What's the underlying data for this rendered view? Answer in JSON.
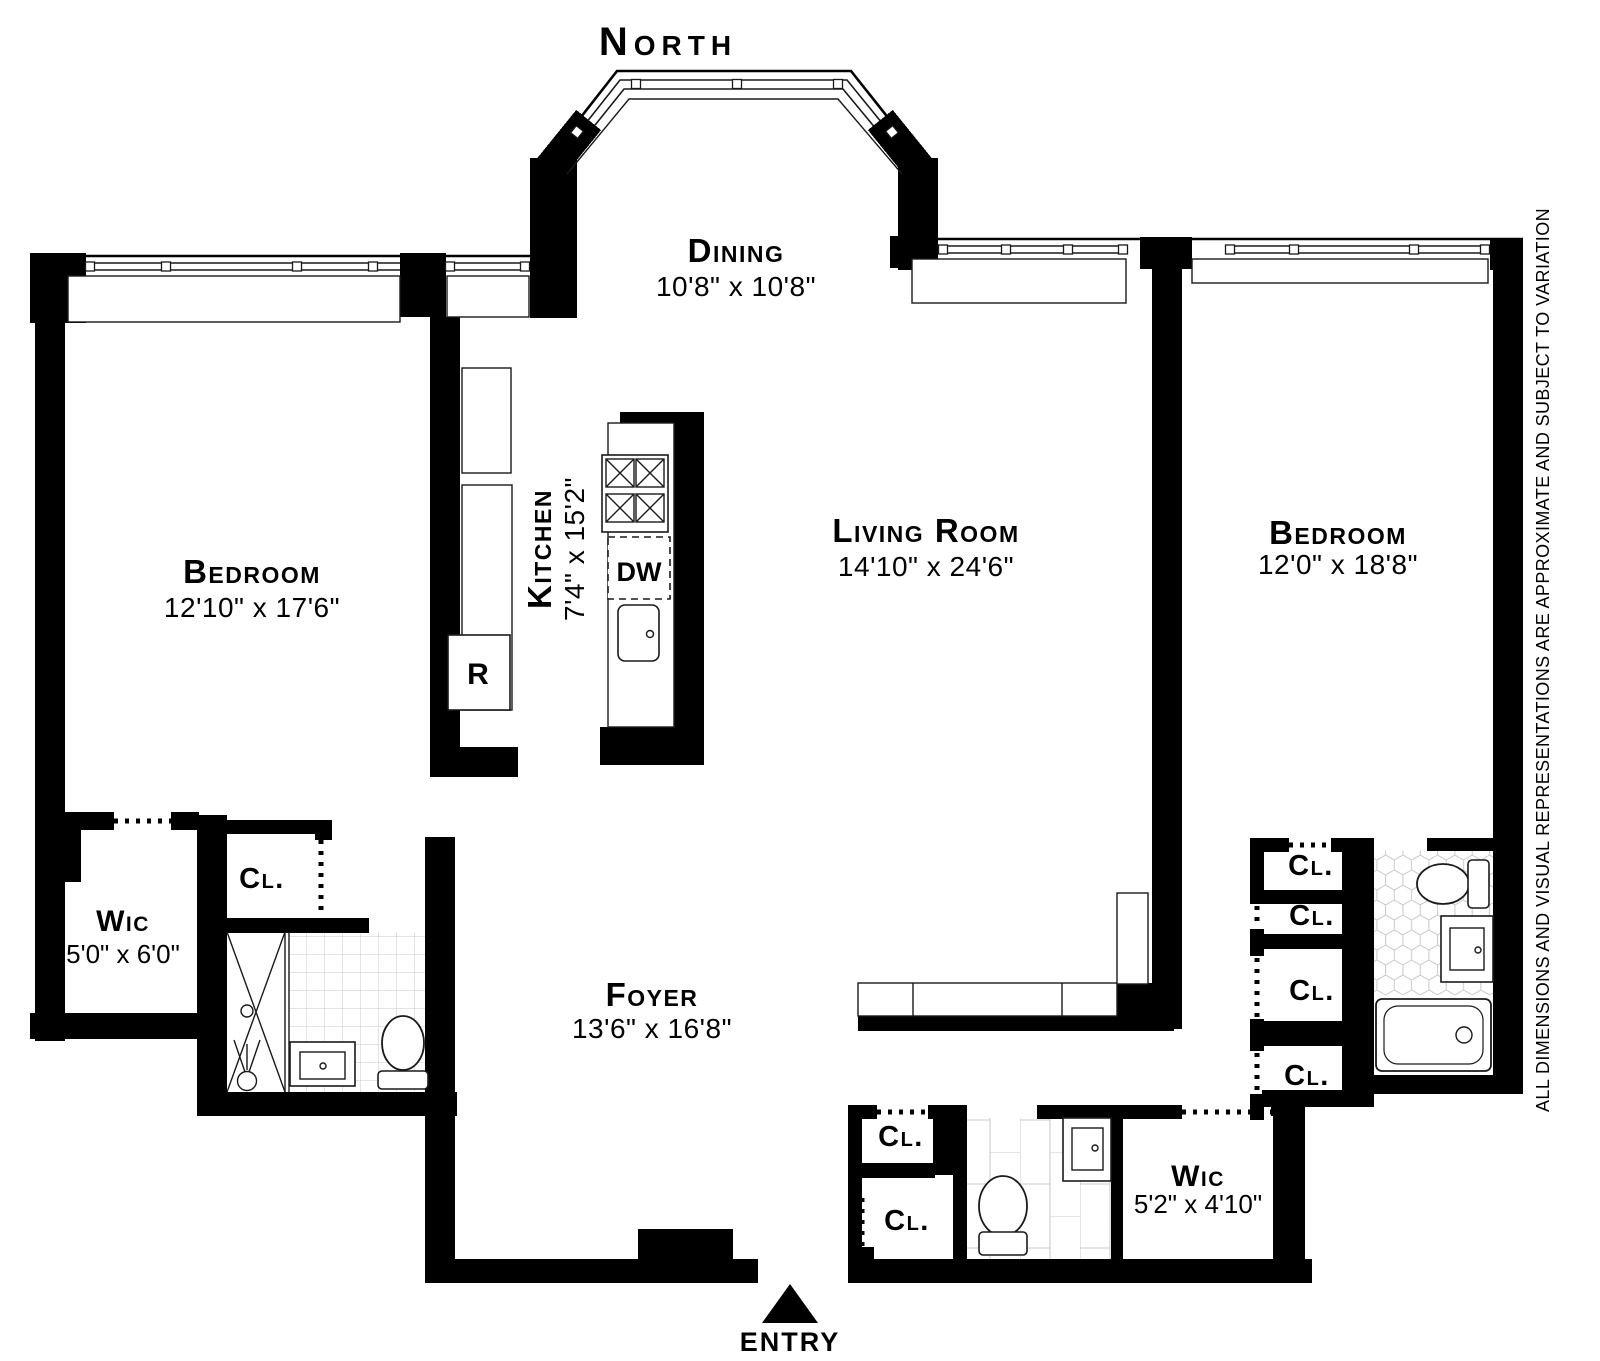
{
  "compass": {
    "label": "North"
  },
  "rooms": [
    {
      "name": "Dining",
      "dims": "10'8\" x 10'8\""
    },
    {
      "name": "Bedroom",
      "dims": "12'10\" x 17'6\""
    },
    {
      "name": "Kitchen",
      "dims": "7'4\" x 15'2\""
    },
    {
      "name": "Living Room",
      "dims": "14'10\" x 24'6\""
    },
    {
      "name": "Bedroom",
      "dims": "12'0\" x 18'8\""
    },
    {
      "name": "Wic",
      "dims": "5'0\" x 6'0\""
    },
    {
      "name": "Foyer",
      "dims": "13'6\" x 16'8\""
    },
    {
      "name": "Wic",
      "dims": "5'2\" x 4'10\""
    }
  ],
  "closets": {
    "label": "Cl."
  },
  "appliances": {
    "refrigerator": "R",
    "dishwasher": "DW"
  },
  "entry": {
    "label": "ENTRY"
  },
  "disclaimer": "ALL DIMENSIONS AND VISUAL REPRESENTATIONS ARE APPROXIMATE AND SUBJECT TO VARIATION",
  "colors": {
    "wall": "#000000",
    "background": "#ffffff",
    "tile_line": "#c9c9c9"
  }
}
